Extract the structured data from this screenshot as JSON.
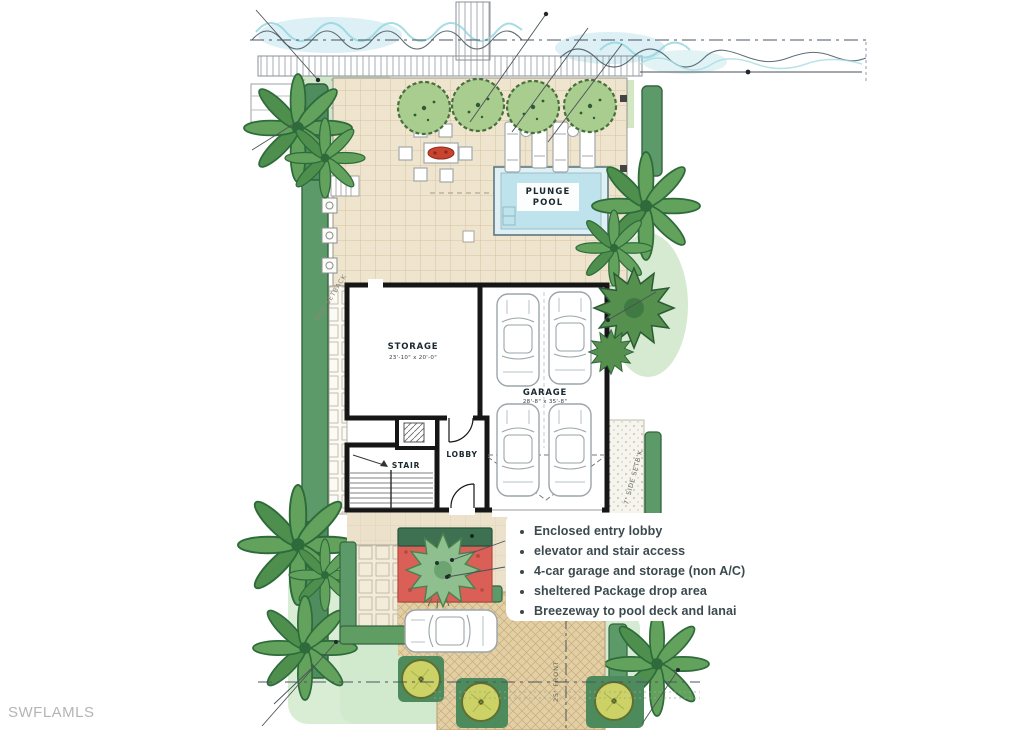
{
  "watermark": "SWFLAMLS",
  "plan_labels": {
    "pool_line1": "PLUNGE",
    "pool_line2": "POOL",
    "storage": "STORAGE",
    "storage_dims": "23'-10\" x 20'-0\"",
    "garage": "GARAGE",
    "garage_dims": "28'-8\" x 35'-8\"",
    "lobby": "LOBBY",
    "stair": "STAIR",
    "side_setback_left": "SIDE SETBACK",
    "side_setback_right": "7' SIDE SETB'K",
    "front_setback": "25' FRONT"
  },
  "annotations": {
    "items": [
      "Enclosed entry lobby",
      "elevator and stair access",
      "4-car garage and storage (non A/C)",
      "sheltered Package drop area",
      "Breezeway to pool deck and lanai"
    ]
  },
  "colors": {
    "paper": "#ffffff",
    "deck_tile": "#efe5cf",
    "driveway": "#e2cfa4",
    "pool_water": "#bfe3ec",
    "water_line": "#8fd4de",
    "hedge_green": "#5c9a69",
    "dark_hedge": "#3e7152",
    "lawn_wash": "#d2e7c3",
    "entry_court_red": "#d95f57",
    "wall_ink": "#161616",
    "annotation_text": "#3b4a4e",
    "watermark_gray": "#b5b5b5"
  }
}
